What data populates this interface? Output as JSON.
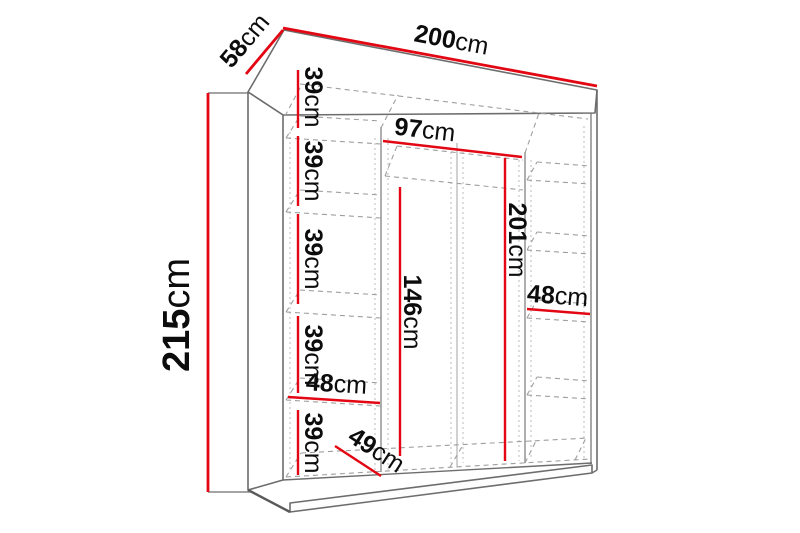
{
  "diagram": {
    "type": "furniture-dimension-diagram",
    "subject": "wardrobe",
    "unit": "cm",
    "colors": {
      "dimension_line": "#e30613",
      "outline": "#6d6d6d",
      "dashed_line": "#9e9e9e",
      "text": "#0c0c0c",
      "background": "#ffffff"
    },
    "overall_dimensions": {
      "width": {
        "value": "200",
        "unit": "cm"
      },
      "depth": {
        "value": "58",
        "unit": "cm"
      },
      "height": {
        "value": "215",
        "unit": "cm"
      }
    },
    "interior_dimensions": {
      "left_shelf_gaps": [
        {
          "value": "39",
          "unit": "cm"
        },
        {
          "value": "39",
          "unit": "cm"
        },
        {
          "value": "39",
          "unit": "cm"
        },
        {
          "value": "39",
          "unit": "cm"
        },
        {
          "value": "39",
          "unit": "cm"
        }
      ],
      "left_column_width": {
        "value": "48",
        "unit": "cm"
      },
      "middle_section_width": {
        "value": "97",
        "unit": "cm"
      },
      "interior_height": {
        "value": "201",
        "unit": "cm"
      },
      "hanging_space_height": {
        "value": "146",
        "unit": "cm"
      },
      "right_column_width": {
        "value": "48",
        "unit": "cm"
      },
      "interior_depth": {
        "value": "49",
        "unit": "cm"
      }
    }
  }
}
